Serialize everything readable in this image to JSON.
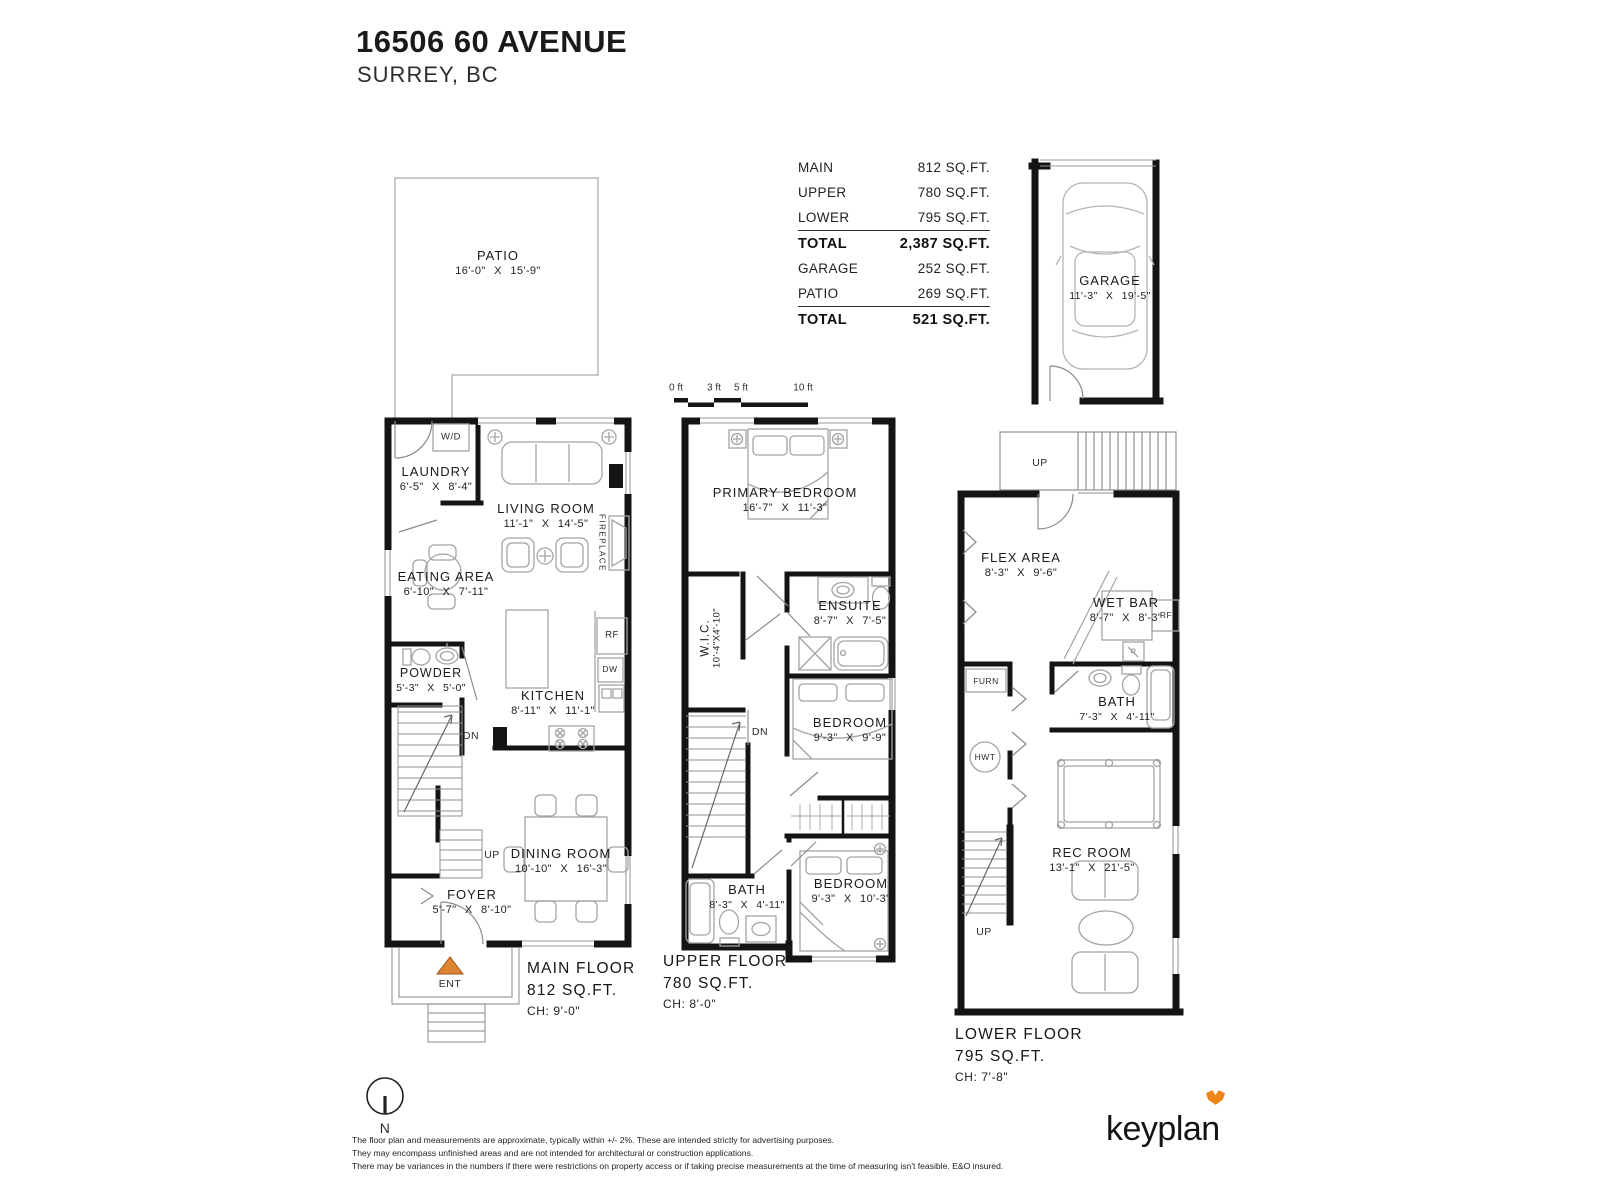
{
  "title": {
    "address": "16506 60 AVENUE",
    "city": "SURREY, BC"
  },
  "area_table": {
    "rows": [
      {
        "label": "MAIN",
        "value": "812 SQ.FT."
      },
      {
        "label": "UPPER",
        "value": "780 SQ.FT."
      },
      {
        "label": "LOWER",
        "value": "795 SQ.FT."
      },
      {
        "label": "TOTAL",
        "value": "2,387 SQ.FT."
      },
      {
        "label": "GARAGE",
        "value": "252 SQ.FT."
      },
      {
        "label": "PATIO",
        "value": "269 SQ.FT."
      },
      {
        "label": "TOTAL",
        "value": "521 SQ.FT."
      }
    ]
  },
  "scale_bar": {
    "labels": [
      "0 ft",
      "3 ft",
      "5 ft",
      "10 ft"
    ]
  },
  "garage": {
    "name": "GARAGE",
    "dims": "11'-3\" X 19'-5\""
  },
  "patio": {
    "name": "PATIO",
    "dims": "16'-0\" X 15'-9\""
  },
  "main_floor": {
    "title": "MAIN FLOOR",
    "area": "812 SQ.FT.",
    "ceiling": "CH: 9'-0\"",
    "rooms": {
      "laundry": {
        "name": "LAUNDRY",
        "dims": "6'-5\" X 8'-4\""
      },
      "living": {
        "name": "LIVING ROOM",
        "dims": "11'-1\" X 14'-5\""
      },
      "eating": {
        "name": "EATING AREA",
        "dims": "6'-10\" X 7'-11\""
      },
      "powder": {
        "name": "POWDER",
        "dims": "5'-3\" X 5'-0\""
      },
      "kitchen": {
        "name": "KITCHEN",
        "dims": "8'-11\" X 11'-1\""
      },
      "dining": {
        "name": "DINING ROOM",
        "dims": "10'-10\" X 16'-3\""
      },
      "foyer": {
        "name": "FOYER",
        "dims": "5'-7\" X 8'-10\""
      }
    },
    "annotations": {
      "wd": "W/D",
      "fireplace": "FIREPLACE",
      "rf": "RF",
      "dw": "DW",
      "dn": "DN",
      "up": "UP",
      "ent": "ENT"
    }
  },
  "upper_floor": {
    "title": "UPPER FLOOR",
    "area": "780 SQ.FT.",
    "ceiling": "CH: 8'-0\"",
    "rooms": {
      "primary": {
        "name": "PRIMARY BEDROOM",
        "dims": "16'-7\" X 11'-3\""
      },
      "wic": {
        "name": "W.I.C.",
        "dims": "10'-4\"X4'-10\""
      },
      "ensuite": {
        "name": "ENSUITE",
        "dims": "8'-7\" X 7'-5\""
      },
      "bedroom1": {
        "name": "BEDROOM",
        "dims": "9'-3\" X 9'-9\""
      },
      "bath": {
        "name": "BATH",
        "dims": "8'-3\" X 4'-11\""
      },
      "bedroom2": {
        "name": "BEDROOM",
        "dims": "9'-3\" X 10'-3\""
      }
    },
    "annotations": {
      "dn": "DN"
    }
  },
  "lower_floor": {
    "title": "LOWER FLOOR",
    "area": "795 SQ.FT.",
    "ceiling": "CH: 7'-8\"",
    "rooms": {
      "flex": {
        "name": "FLEX AREA",
        "dims": "8'-3\" X 9'-6\""
      },
      "wetbar": {
        "name": "WET BAR",
        "dims": "8'-7\" X 8'-3\""
      },
      "bath": {
        "name": "BATH",
        "dims": "7'-3\" X 4'-11\""
      },
      "rec": {
        "name": "REC ROOM",
        "dims": "13'-1\" X 21'-5\""
      }
    },
    "annotations": {
      "up_top": "UP",
      "furn": "FURN",
      "hwt": "HWT",
      "rf": "RF",
      "up_bottom": "UP"
    }
  },
  "compass": {
    "north": "N"
  },
  "disclaimer": {
    "line1": "The floor plan and measurements are approximate, typically within +/- 2%. These are intended strictly for advertising purposes.",
    "line2": "They may encompass unfinished areas and are not intended for architectural or construction applications.",
    "line3": "There may be variances in the numbers if there were restrictions on property access or if taking precise measurements at the time of measuring isn't feasible. E&O insured."
  },
  "logo": {
    "text": "keyplan"
  },
  "colors": {
    "ent_arrow": "#DD8434",
    "logo_fox": "#EF8718",
    "walls": "#141414"
  }
}
